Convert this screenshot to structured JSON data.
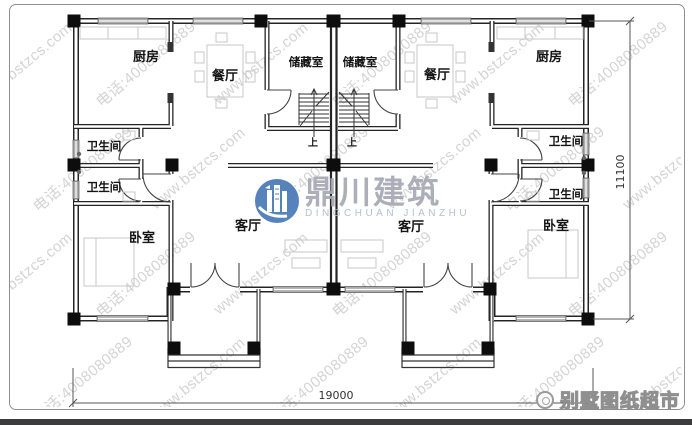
{
  "watermark": {
    "site": "www.bstzcs.com",
    "phone": "电话:4008080889"
  },
  "logo": {
    "name_cn": "鼎川建筑",
    "name_en": "DINGCHUAN JIANZHU",
    "icon": "building-circle-icon",
    "circle_color": "#4a7ab8",
    "cn_text_color": "#a6aab4",
    "en_text_color": "#a9bcd4"
  },
  "badge": {
    "label": "别墅图纸超市",
    "icon": "stamp-spiral-icon"
  },
  "dimensions": {
    "width_mm": "19000",
    "height_mm": "11100"
  },
  "rooms": {
    "kitchen_left": "厨房",
    "kitchen_right": "厨房",
    "dining_left": "餐厅",
    "dining_right": "餐厅",
    "storage_left": "储藏室",
    "storage_right": "储藏室",
    "bath_left_top": "卫生间",
    "bath_left_bottom": "卫生间",
    "bath_right_top": "卫生间",
    "bath_right_bottom": "卫生间",
    "bedroom_left": "卧室",
    "bedroom_right": "卧室",
    "living_left": "客厅",
    "living_right": "客厅",
    "stair_up_left": "上",
    "stair_up_right": "上"
  },
  "colors": {
    "wall": "#242424",
    "window_fill": "#adadad",
    "dimension": "#555555",
    "footer_bar": "#3b3b3d",
    "border": "#8f8f8f"
  }
}
